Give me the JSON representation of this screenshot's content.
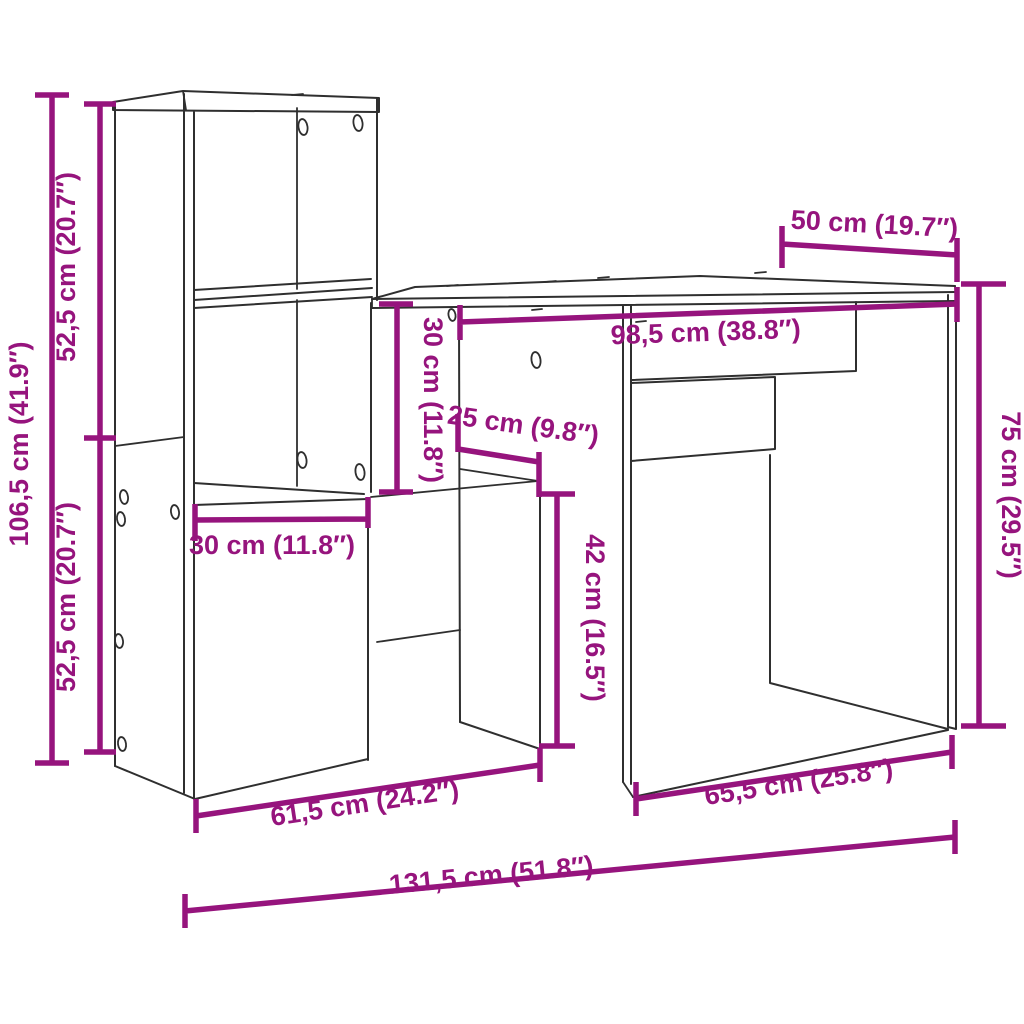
{
  "figure": {
    "kind": "furniture-dimension-diagram",
    "subject": "desk-with-shelving-unit",
    "background_color": "#ffffff",
    "outline_color": "#2f2f2f",
    "dimension_color": "#96147D"
  },
  "dimensions": {
    "total_height": {
      "label": "106,5 cm (41.9″)"
    },
    "upper_section_height": {
      "label": "52,5 cm (20.7″)"
    },
    "lower_section_height": {
      "label": "52,5 cm (20.7″)"
    },
    "desk_depth": {
      "label": "50 cm (19.7″)"
    },
    "desktop_width": {
      "label": "98,5 cm (38.8″)"
    },
    "compartment_height": {
      "label": "30 cm (11.8″)"
    },
    "compartment_depth": {
      "label": "25 cm (9.8″)"
    },
    "compartment_width": {
      "label": "30 cm (11.8″)"
    },
    "knee_clearance_height": {
      "label": "42 cm (16.5″)"
    },
    "desk_height": {
      "label": "75 cm (29.5″)"
    },
    "left_section_width": {
      "label": "61,5 cm (24.2″)"
    },
    "right_section_width": {
      "label": "65,5 cm (25.8″)"
    },
    "total_width": {
      "label": "131,5 cm (51.8″)"
    }
  }
}
